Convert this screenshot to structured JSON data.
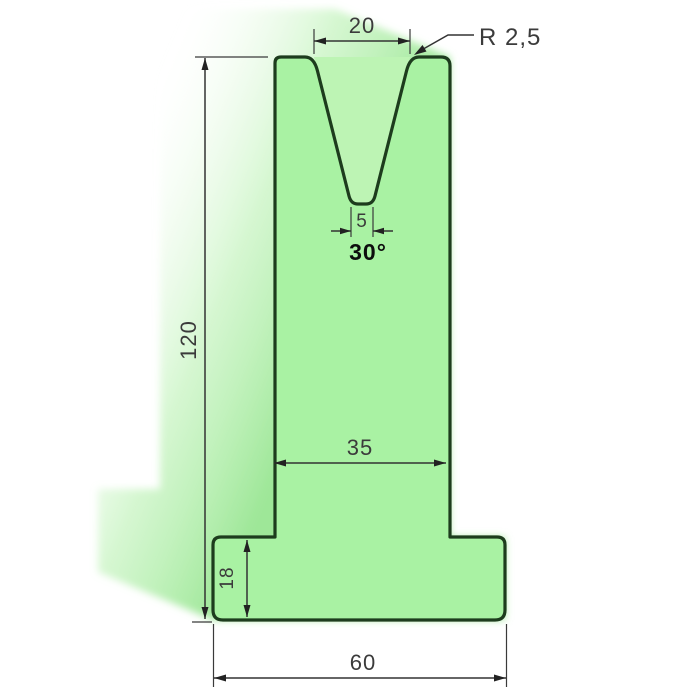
{
  "drawing": {
    "kind": "press-brake V-die cross-section technical drawing",
    "dims": {
      "vee_opening": {
        "label": "20"
      },
      "corner_radius": {
        "label": "R 2,5"
      },
      "vee_bottom": {
        "label": "5"
      },
      "vee_angle": {
        "label": "30°"
      },
      "total_height": {
        "label": "120"
      },
      "body_width": {
        "label": "35"
      },
      "base_height": {
        "label": "18"
      },
      "base_width": {
        "label": "60"
      }
    },
    "colors": {
      "background": "#ffffff",
      "die_fill": "#a9f2a3",
      "groove_fill": "#bdf4b4",
      "outline": "#1d3c1d",
      "dimension_lines": "#333333",
      "shadow_green": "#8de386"
    }
  }
}
